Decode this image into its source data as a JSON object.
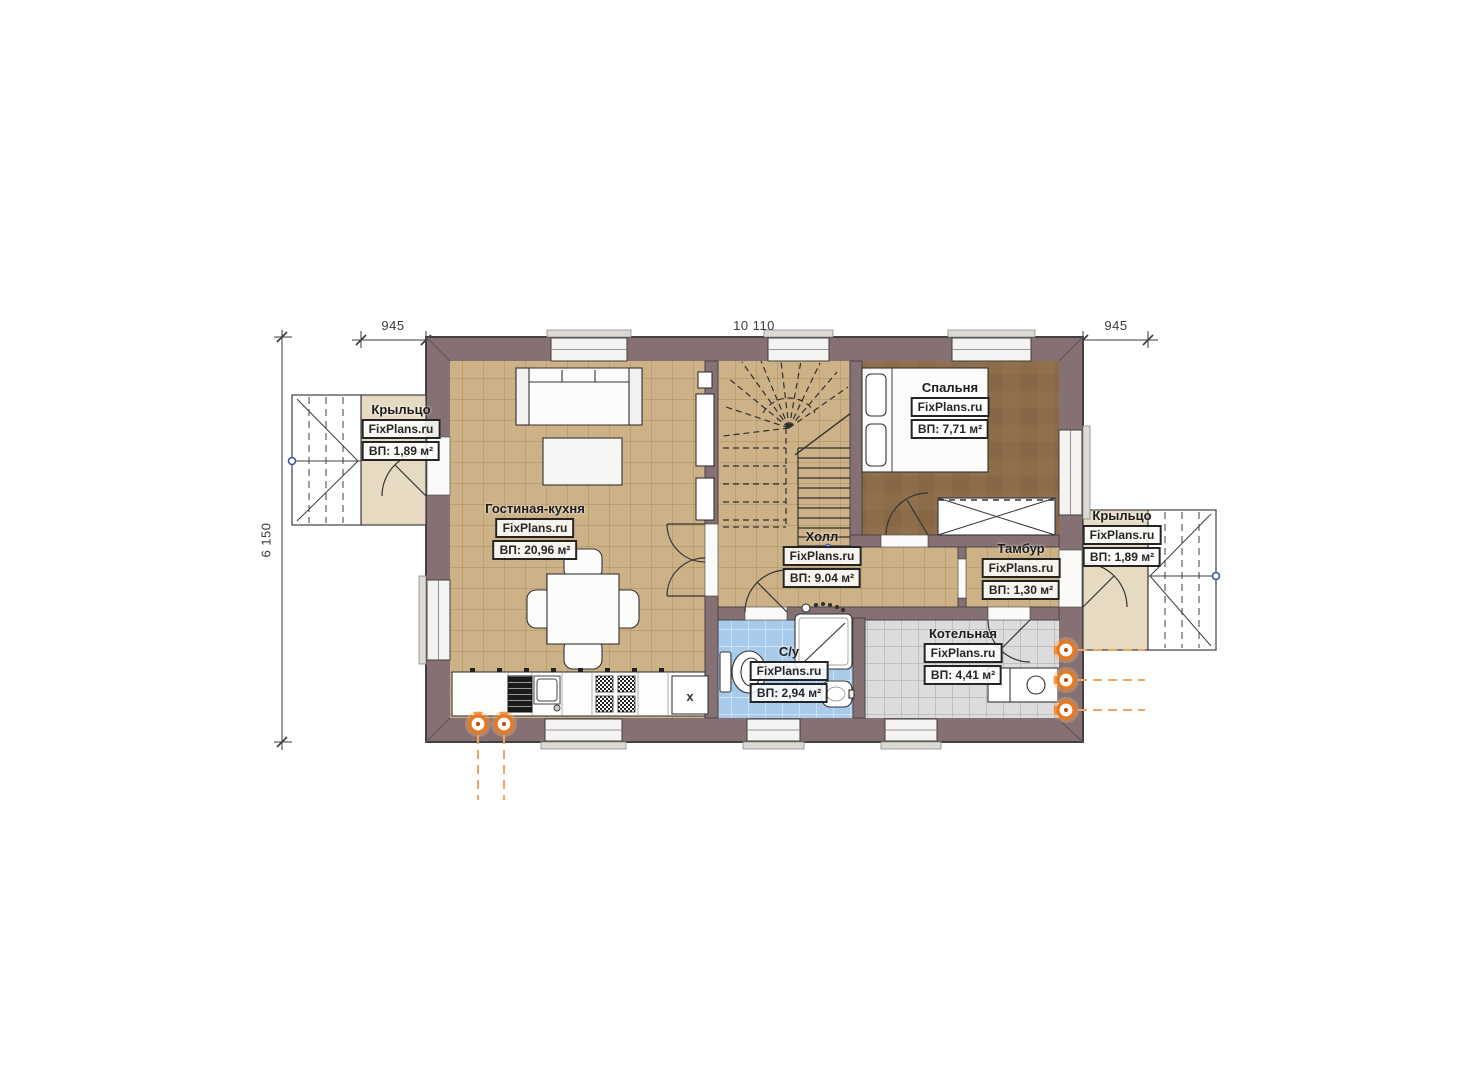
{
  "site_brand": "FixPlans.ru",
  "dims": {
    "top_left": "945",
    "top_center": "10 110",
    "top_right": "945",
    "left": "6 150"
  },
  "labels": {
    "fridge_mark": "x"
  },
  "rooms": {
    "living": {
      "name": "Гостиная-кухня",
      "brand": "FixPlans.ru",
      "area": "ВП: 20,96 м²"
    },
    "hall": {
      "name": "Холл",
      "brand": "FixPlans.ru",
      "area": "ВП: 9.04 м²"
    },
    "bedroom": {
      "name": "Спальня",
      "brand": "FixPlans.ru",
      "area": "ВП: 7,71 м²"
    },
    "tambour": {
      "name": "Тамбур",
      "brand": "FixPlans.ru",
      "area": "ВП: 1,30 м²"
    },
    "bathroom": {
      "name": "С/у",
      "brand": "FixPlans.ru",
      "area": "ВП: 2,94 м²"
    },
    "boiler": {
      "name": "Котельная",
      "brand": "FixPlans.ru",
      "area": "ВП: 4,41 м²"
    },
    "porch_left": {
      "name": "Крыльцо",
      "brand": "FixPlans.ru",
      "area": "ВП: 1,89 м²"
    },
    "porch_right": {
      "name": "Крыльцо",
      "brand": "FixPlans.ru",
      "area": "ВП: 1,89 м²"
    }
  },
  "colors": {
    "wall": "#857073",
    "floor_tile_tan": "#cdb287",
    "bedroom_floor": "#8c6d49",
    "bathroom_tile": "#a8cbec",
    "boiler_tile": "#dcdcdc",
    "porch_floor": "#e6dac2",
    "utility_orange": "#e8791d",
    "dimension_ink": "#3a3a3a",
    "marker_blue": "#3c55b0"
  }
}
